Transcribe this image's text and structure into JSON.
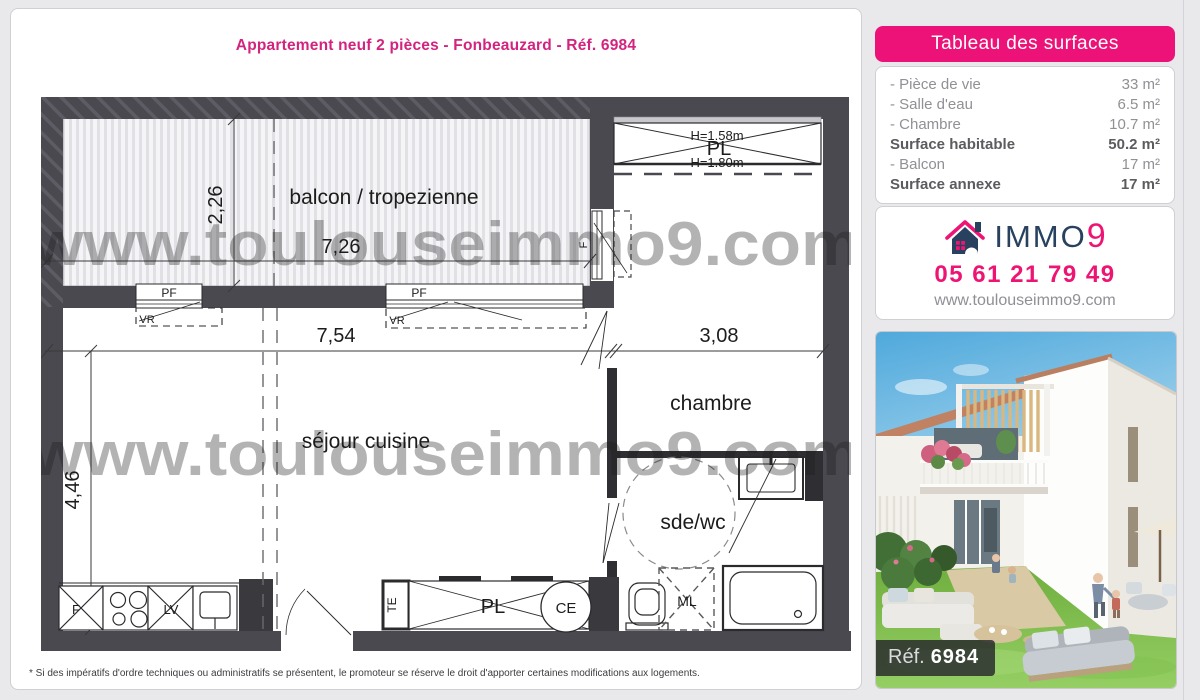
{
  "page": {
    "title": "Appartement neuf 2 pièces - Fonbeauzard - Réf. 6984",
    "disclaimer": "* Si des impératifs d'ordre techniques ou administratifs se présentent, le promoteur se réserve le droit d'apporter certaines modifications aux logements."
  },
  "plan": {
    "watermark": "www.toulouseimmo9.com",
    "rooms": {
      "balcony": "balcon / tropezienne",
      "living": "séjour cuisine",
      "bedroom": "chambre",
      "bathroom": "sde/wc"
    },
    "closet_top": {
      "label": "PL",
      "height_top": "H=1.58m",
      "height_bottom": "H=1.80m"
    },
    "dimensions": {
      "balcony_depth": "2,26",
      "balcony_width": "7,26",
      "living_width": "7,54",
      "living_depth": "4,46",
      "bedroom_width": "3,08"
    },
    "annotations": {
      "window_full": "PF",
      "shutter": "VR",
      "window": "F",
      "fridge": "F",
      "dishwasher": "LV",
      "electrical": "TE",
      "closet": "PL",
      "water_heater": "CE",
      "washing_machine": "ML"
    }
  },
  "surfaces": {
    "header": "Tableau des surfaces",
    "rows": [
      {
        "label": "- Pièce de vie",
        "value": "33 m²"
      },
      {
        "label": "- Salle d'eau",
        "value": "6.5 m²"
      },
      {
        "label": "- Chambre",
        "value": "10.7 m²"
      },
      {
        "label": "Surface habitable",
        "value": "50.2 m²"
      },
      {
        "label": "- Balcon",
        "value": "17 m²"
      },
      {
        "label": "Surface annexe",
        "value": "17 m²"
      }
    ]
  },
  "agency": {
    "brand_main": "IMMO",
    "brand_digit": "9",
    "phone": "05 61 21 79 49",
    "website": "www.toulouseimmo9.com"
  },
  "photo": {
    "ref_label": "Réf.",
    "ref_number": "6984"
  },
  "colors": {
    "pink": "#ed1277",
    "navy": "#27415e",
    "wall_gray": "#4a4950"
  }
}
